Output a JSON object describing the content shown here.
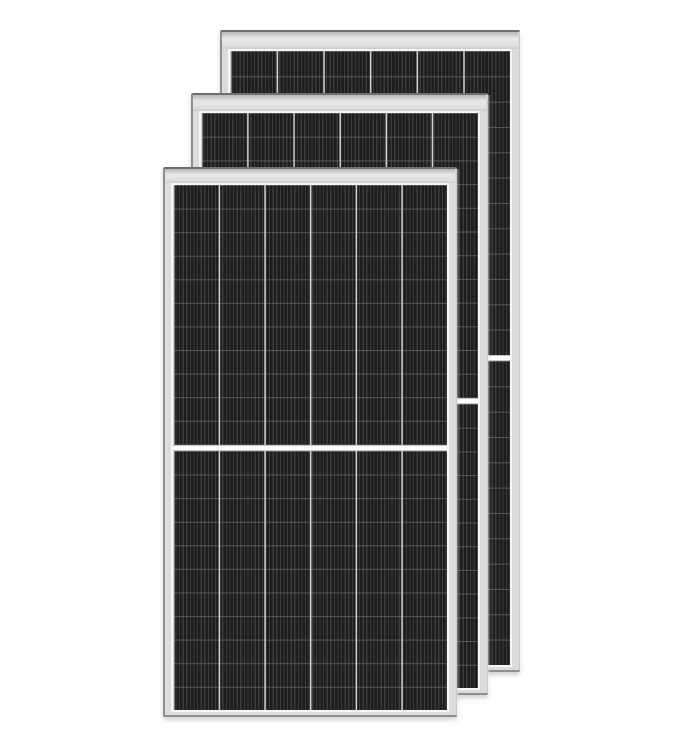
{
  "meta": {
    "subject": "three-overlapping-framed-solar-panels",
    "background_color": "#ffffff",
    "canvas": {
      "width": 684,
      "height": 748
    }
  },
  "colors": {
    "frame_fill": "#dcdcdc",
    "frame_edge_top": "#6f6f6f",
    "frame_edge": "#8f8f8f",
    "band_top": "#b8b8b8",
    "band_mid": "#e8e8e8",
    "band_low": "#dfdfdf",
    "band_bottom": "#cccccc",
    "inner_margin": "#f6f6f6",
    "cell_base": "#262626",
    "finger_dark": "#1e1e1e",
    "finger_light": "#3a3a3a",
    "column_separator": "#d2d2d2",
    "row_line": "rgba(255,255,255,0.22)",
    "divider_fill": "#fcfcfc",
    "divider_edge": "#c8c8c8",
    "right_glow": "rgba(255,255,255,0.75)"
  },
  "panels": [
    {
      "id": "back",
      "x": 220,
      "y": 30,
      "width": 300,
      "height": 642,
      "z": 1,
      "band_height": 17,
      "side_pad": 6,
      "bottom_pad": 3,
      "columns": 6,
      "rows_per_half": 12,
      "divider_height": 6,
      "finger_period": 3.6,
      "finger_dark_width": 2.4
    },
    {
      "id": "middle",
      "x": 191,
      "y": 93,
      "width": 297,
      "height": 602,
      "z": 2,
      "band_height": 16,
      "side_pad": 6,
      "bottom_pad": 3,
      "columns": 6,
      "rows_per_half": 12,
      "divider_height": 6,
      "finger_period": 3.6,
      "finger_dark_width": 2.4
    },
    {
      "id": "front",
      "x": 163,
      "y": 167,
      "width": 294,
      "height": 550,
      "z": 3,
      "band_height": 14,
      "side_pad": 6,
      "bottom_pad": 3,
      "columns": 6,
      "rows_per_half": 11,
      "divider_height": 6,
      "finger_period": 3.6,
      "finger_dark_width": 2.4
    }
  ]
}
